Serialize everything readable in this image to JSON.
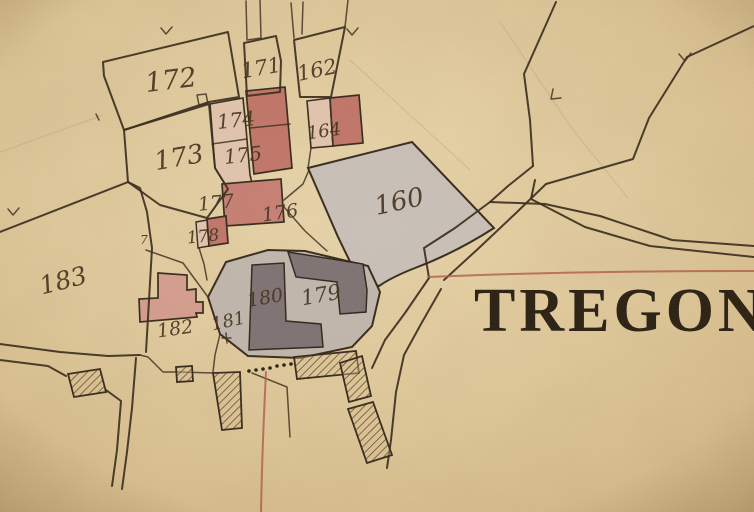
{
  "map": {
    "place_name": "TREGON",
    "boundary_mark": "7",
    "parcel_numbers": [
      "172",
      "171",
      "162",
      "174",
      "173",
      "175",
      "164",
      "160",
      "177",
      "176",
      "178",
      "183",
      "182",
      "181",
      "180",
      "179"
    ],
    "symbols": [
      "boundary-chevron",
      "survey-cross",
      "dotted-path",
      "hatched-wall"
    ],
    "colors": {
      "parchment": "#e8d3a6",
      "ink": "#33271a",
      "building_red": "#c4766b",
      "building_pink": "#d9a093",
      "wash_pink": "#e6c9b4",
      "parcel_gray": "#cbc3bd",
      "courtyard_gray": "#c3bab2",
      "building_dark": "#7e7276",
      "survey_line_red": "#b45947"
    }
  }
}
